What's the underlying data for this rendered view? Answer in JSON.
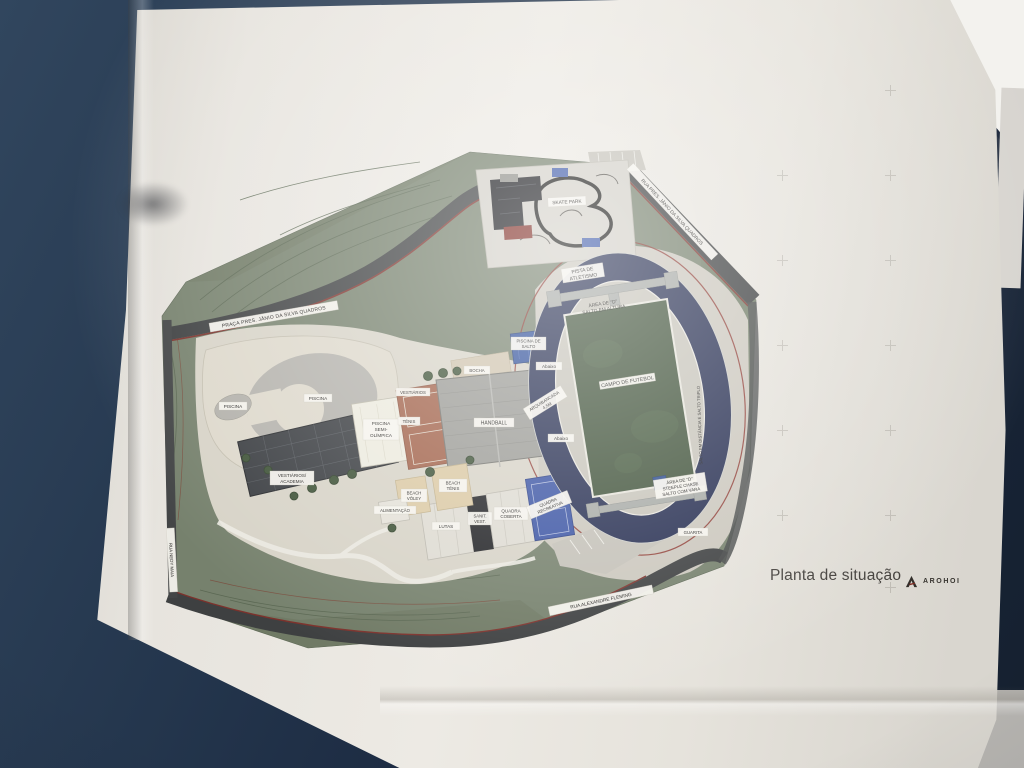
{
  "title_block": {
    "title": "Planta de situação",
    "brand": "AROHOI",
    "brand_mark_icon": "a-monogram-icon"
  },
  "colors": {
    "desk": "#1f3048",
    "paper": "#e8e5df",
    "site_green": "#76816d",
    "road": "#3e4041",
    "track_navy": "#272f52",
    "field_green": "#42543c",
    "pool_water": "#b4b2ac",
    "dive_pool_blue": "#30509a",
    "clay_court": "#a2634b",
    "sand_court": "#dbc9a4",
    "blue_court": "#3c55a4",
    "property_line_red": "#8a2f28"
  },
  "plan": {
    "roads": {
      "praca": "PRAÇA PRES. JÂNIO DA SILVA QUADROS",
      "rua_nordeste": "RUA PRES. JÂNIO DA SILVA QUADROS",
      "rua_sul": "RUA ALEXANDRE FLEMING",
      "rua_oeste": "RUA NEDY MAIA"
    },
    "track": {
      "pista_l1": "PISTA DE",
      "pista_l2": "ATLETISMO",
      "area_norte_l1": "ÁREA DE \"D\"",
      "area_norte_l2": "SALTO EM ALTURA",
      "campo": "CAMPO DE FUTEBOL",
      "area_sul_l1": "ÁREA DE \"D\"",
      "area_sul_l2": "STEEPLE CHASE",
      "area_sul_l3": "SALTO COM VARA",
      "reta_lateral": "SALTO EM DISTÂNCIA E SALTO TRIPLO",
      "guarita": "GUARITA"
    },
    "aquatics": {
      "piscina_grande": "PISCINA",
      "piscina_pequena": "PISCINA",
      "semi_l1": "PISCINA",
      "semi_l2": "SEMI-",
      "semi_l3": "OLÍMPICA",
      "salto_l1": "PISCINA DE",
      "salto_l2": "SALTO"
    },
    "buildings": {
      "vestiarios": "VESTIÁRIOS",
      "tenis": "TÊNIS",
      "handball": "HANDBALL",
      "bocha": "BOCHA",
      "arquibancada_l1": "ARQUIBANCADA",
      "arquibancada_l2": "4,5M",
      "abaixo_1": "Abaixo",
      "abaixo_2": "Abaixo",
      "vest_acad_l1": "VESTIÁRIOS/",
      "vest_acad_l2": "ACADEMIA",
      "beach_voley_l1": "BEACH",
      "beach_voley_l2": "VÔLEY",
      "beach_tenis_l1": "BEACH",
      "beach_tenis_l2": "TÊNIS",
      "alimentacao": "ALIMENTAÇÃO",
      "lutas": "LUTAS",
      "sanit_l1": "SANIT.",
      "sanit_l2": "VEST.",
      "quadra_coberta_l1": "QUADRA",
      "quadra_coberta_l2": "COBERTA",
      "quadra_recreativa_l1": "QUADRA",
      "quadra_recreativa_l2": "RECREATIVA",
      "skate": "SKATE PARK"
    }
  }
}
